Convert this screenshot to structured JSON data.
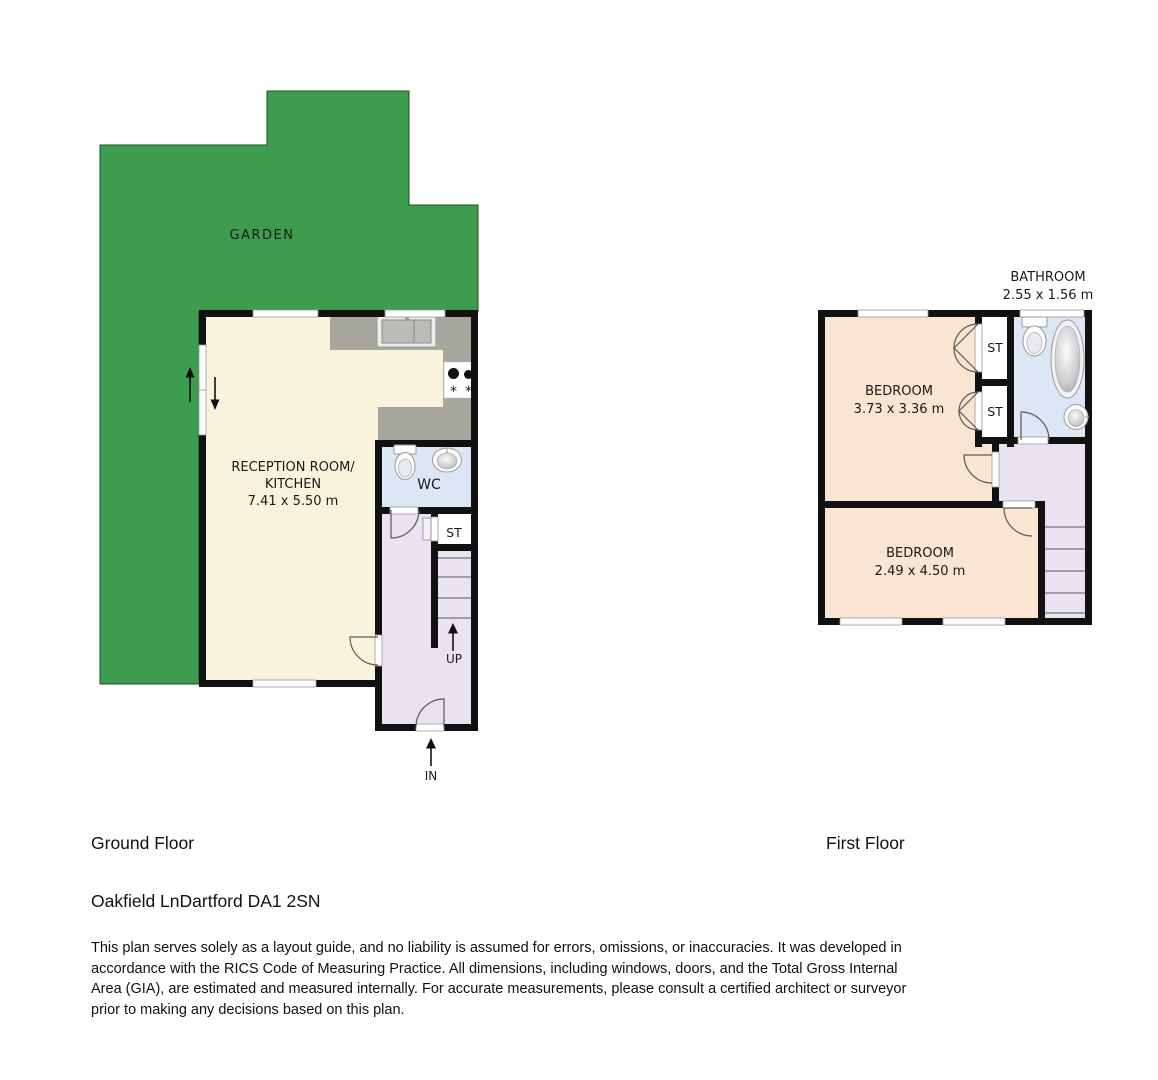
{
  "colors": {
    "garden_green": "#3E9C4F",
    "wall": "#111111",
    "floor_cream": "#F7F3DC",
    "counter_gray": "#A7A79F",
    "bath_blue": "#DCE6F5",
    "hall_lavender": "#E9E3F1",
    "bedroom_peach": "#FAE4D2"
  },
  "ground_floor": {
    "caption": "Ground Floor",
    "garden_label": "GARDEN",
    "reception_line1": "RECEPTION ROOM/",
    "reception_line2": "KITCHEN",
    "reception_dims": "7.41 x 5.50 m",
    "wc_label": "WC",
    "st_label": "ST",
    "up_label": "UP",
    "in_label": "IN"
  },
  "first_floor": {
    "caption": "First Floor",
    "bathroom_name": "BATHROOM",
    "bathroom_dims": "2.55 x 1.56 m",
    "bedroom1_name": "BEDROOM",
    "bedroom1_dims": "3.73 x 3.36 m",
    "bedroom2_name": "BEDROOM",
    "bedroom2_dims": "2.49 x 4.50 m",
    "st1_label": "ST",
    "st2_label": "ST"
  },
  "footer": {
    "address": "Oakfield LnDartford DA1 2SN",
    "disclaimer": "This plan serves solely as a layout guide, and no liability is assumed for errors, omissions, or inaccuracies. It was developed in accordance with the RICS Code of Measuring Practice. All dimensions, including windows, doors, and the Total Gross Internal Area (GIA), are estimated and measured internally. For accurate measurements, please consult a certified architect or surveyor prior to making any decisions based on this plan."
  }
}
